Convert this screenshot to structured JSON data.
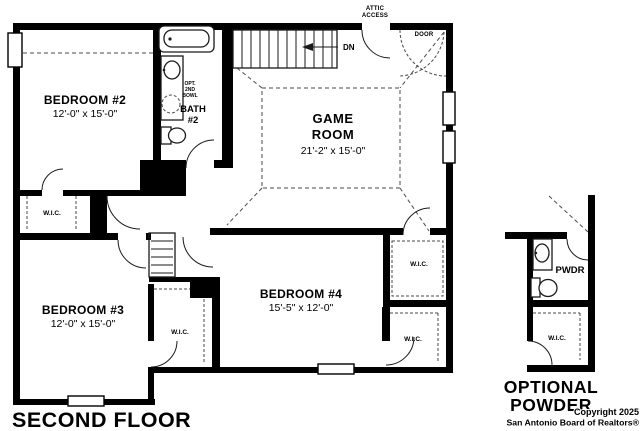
{
  "title": "SECOND FLOOR",
  "detail_title": {
    "line1": "OPTIONAL",
    "line2": "POWDER"
  },
  "copyright": {
    "line1": "Copyright 2025",
    "line2": "San Antonio Board of Realtors®"
  },
  "rooms": {
    "bedroom2": {
      "name": "BEDROOM #2",
      "dims": "12'-0\" x 15'-0\""
    },
    "bedroom3": {
      "name": "BEDROOM #3",
      "dims": "12'-0\" x 15'-0\""
    },
    "bedroom4": {
      "name": "BEDROOM #4",
      "dims": "15'-5\" x 12'-0\""
    },
    "game_room": {
      "line1": "GAME",
      "line2": "ROOM",
      "dims": "21'-2\" x 15'-0\""
    },
    "bath2": {
      "line1": "BATH",
      "line2": "#2"
    },
    "powder": {
      "name": "PWDR"
    }
  },
  "labels": {
    "wic": "W.I.C.",
    "dn": "DN",
    "attic_line1": "ATTIC",
    "attic_line2": "ACCESS",
    "opt_door_line1": "OPT.",
    "opt_door_line2": "DOOR",
    "opt_bowl_line1": "OPT.",
    "opt_bowl_line2": "2ND",
    "opt_bowl_line3": "BOWL"
  },
  "colors": {
    "wall": "#000000",
    "line": "#1a1a1a",
    "dash": "#4a4a4a",
    "background": "#ffffff"
  }
}
